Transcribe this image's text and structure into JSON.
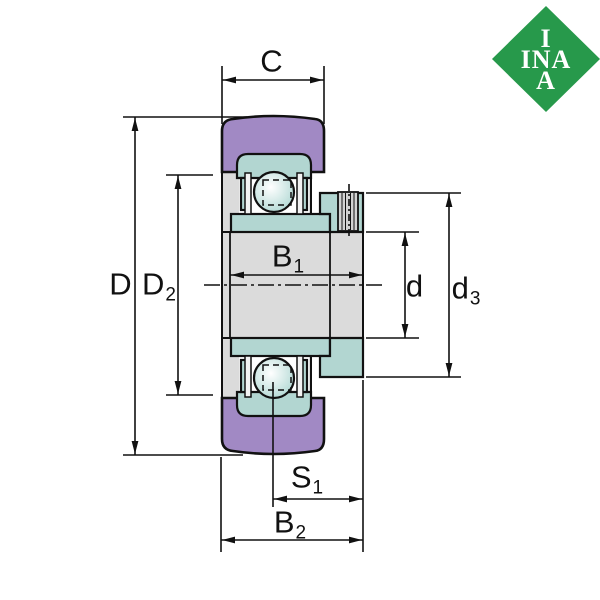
{
  "logo": {
    "line1": "I",
    "line2": "INA",
    "line3": "A"
  },
  "labels": {
    "C": {
      "main": "C",
      "sub": ""
    },
    "D": {
      "main": "D",
      "sub": ""
    },
    "D2": {
      "main": "D",
      "sub": "2"
    },
    "B1": {
      "main": "B",
      "sub": "1"
    },
    "d": {
      "main": "d",
      "sub": ""
    },
    "d3": {
      "main": "d",
      "sub": "3"
    },
    "S1": {
      "main": "S",
      "sub": "1"
    },
    "B2": {
      "main": "B",
      "sub": "2"
    }
  },
  "colors": {
    "logo_green": "#27994B",
    "logo_text": "#FFFFFF",
    "outer_ring_purple": "#A189C4",
    "inner_ring_teal": "#B2D6D1",
    "body_gray": "#DBDBDB",
    "screw_gray": "#D2D2D2",
    "ball_highlight": "#FFFFFF",
    "ball_edge": "#A9D4CF",
    "line_black": "#111111",
    "background": "#FFFFFF"
  }
}
